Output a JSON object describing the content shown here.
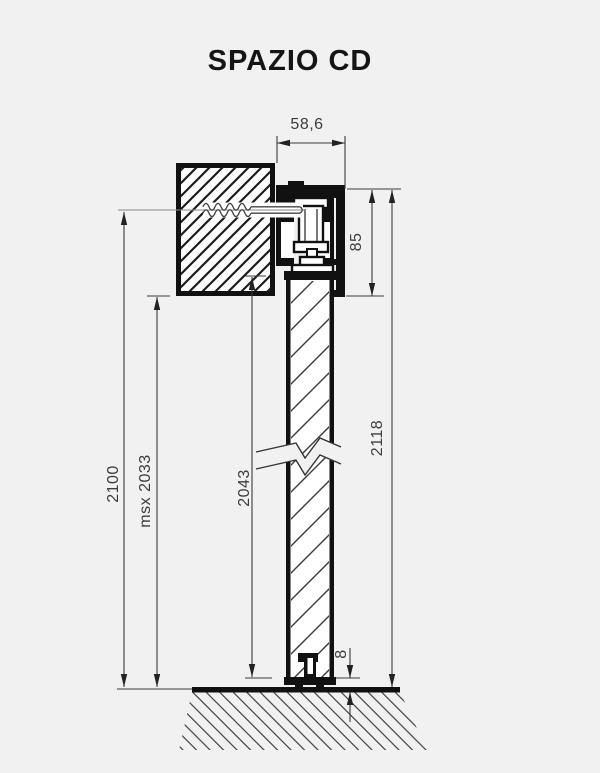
{
  "title": "SPAZIO CD",
  "dimensions": {
    "track_width": "58,6",
    "track_height": "85",
    "overall_height": "2118",
    "door_height": "2043",
    "opening_height": "2100",
    "max_height": "msx 2033",
    "floor_gap": "8"
  },
  "colors": {
    "background": "#f1f1f1",
    "line": "#111111",
    "dimension_line": "#3a3a3a",
    "hatch": "#1c1c1c"
  }
}
